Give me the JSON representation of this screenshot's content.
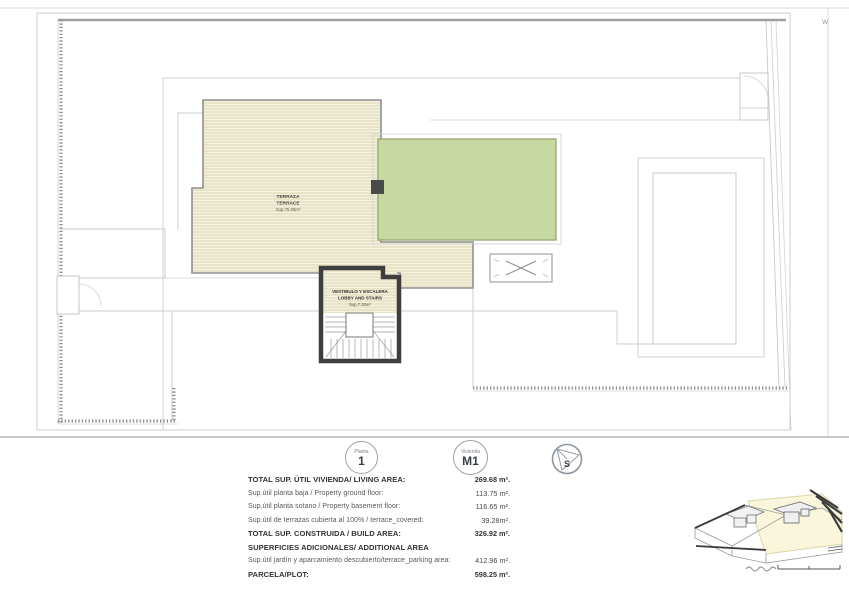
{
  "plan": {
    "watermark": "W",
    "terrace_label": {
      "line1": "TERRAZA",
      "line2": "TERRACE",
      "line3": "Sup.75.80m²"
    },
    "lobby_label": {
      "line1": "VESTIBULO Y ESCALERA",
      "line2": "LOBBY AND STAIRS",
      "line3": "Sup.7.30m²"
    },
    "colors": {
      "terrace_fill": "#f4f1da",
      "terrace_hatch": "#d6d2b2",
      "pool_green": "#c7d8a0",
      "wall_dark": "#3e3e3e",
      "boundary_gray": "#c9c9c9"
    }
  },
  "legend": {
    "floor_badge": {
      "caption": "Planta",
      "value": "1"
    },
    "unit_badge": {
      "caption": "Vivienda",
      "value": "M1"
    },
    "compass": {
      "letter": "S"
    }
  },
  "areas": {
    "rows": [
      {
        "label": "TOTAL SUP. ÚTIL  VIVIENDA/ LIVING AREA:",
        "value": "269.68 m²."
      },
      {
        "label": "Sup.útil planta baja / Property ground floor:",
        "value": "113.75 m²."
      },
      {
        "label": "Sup.útil planta sotano / Property basement floor:",
        "value": "116.65 m²."
      },
      {
        "label": "Sup.útil de terrazas cubierta al 100% / terrace_covered:",
        "value": "39.28m²."
      },
      {
        "label": "TOTAL SUP. CONSTRUIDA / BUILD AREA:",
        "value": "326.92 m²."
      },
      {
        "label": "SUPERFICIES ADICIONALES/ ADDITIONAL AREA",
        "value": ""
      },
      {
        "label": "Sup.útil jardín y aparcamiento descubierto/terrace_parking area:",
        "value": "412.96 m²."
      },
      {
        "label": "PARCELA/PLOT:",
        "value": "598.25 m²."
      }
    ]
  }
}
